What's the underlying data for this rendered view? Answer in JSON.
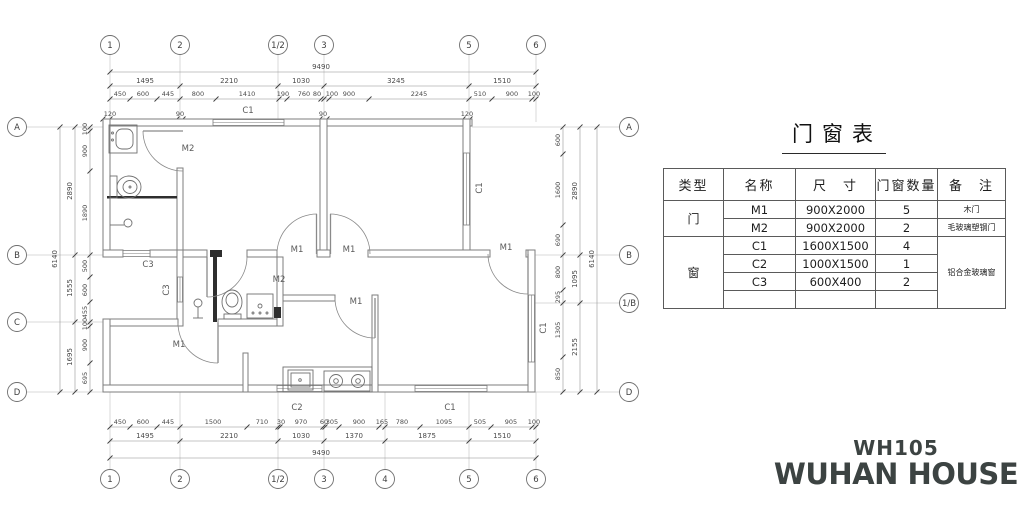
{
  "plan": {
    "bubbles": {
      "top": [
        "1",
        "2",
        "1/2",
        "3",
        "5",
        "6"
      ],
      "bottom": [
        "1",
        "2",
        "1/2",
        "3",
        "4",
        "5",
        "6"
      ],
      "left": [
        "A",
        "B",
        "C",
        "D"
      ],
      "right": [
        "A",
        "B",
        "1/B",
        "D"
      ]
    },
    "dims": {
      "top_total": [
        "9490"
      ],
      "top_row2": [
        "1495",
        "2210",
        "1030",
        "3245",
        "1510"
      ],
      "top_fine": [
        "450",
        "600",
        "445",
        "800",
        "1410",
        "190",
        "760",
        "80",
        "100",
        "900",
        "2245",
        "510",
        "900",
        "100"
      ],
      "wall_callouts": [
        "120",
        "90",
        "90",
        "120"
      ],
      "bottom_fine": [
        "450",
        "600",
        "445",
        "1500",
        "710",
        "30",
        "970",
        "60",
        "305",
        "900",
        "165",
        "780",
        "1095",
        "505",
        "905",
        "100"
      ],
      "bottom_row2": [
        "1495",
        "2210",
        "1030",
        "1370",
        "1875",
        "1510"
      ],
      "bottom_total": [
        "9490"
      ],
      "left_fine": [
        "100",
        "900",
        "1890",
        "500",
        "600",
        "455",
        "100",
        "900",
        "695"
      ],
      "left_row2": [
        "2890",
        "1555",
        "1695"
      ],
      "left_total": [
        "6140"
      ],
      "right_fine": [
        "600",
        "1600",
        "690",
        "800",
        "295",
        "1305",
        "850"
      ],
      "right_row2": [
        "2890",
        "1095",
        "2155"
      ],
      "right_total": [
        "6140"
      ]
    },
    "tags_h": [
      "C1",
      "M2",
      "C3",
      "M2",
      "M1",
      "M1",
      "M1",
      "M1",
      "M1",
      "C2",
      "C1"
    ],
    "tags_v": [
      "C3",
      "C1",
      "C1"
    ]
  },
  "table": {
    "title": "门窗表",
    "headers": [
      "类型",
      "名称",
      "尺　寸",
      "门窗数量",
      "备　注"
    ],
    "type_groups": [
      {
        "label": "门"
      },
      {
        "label": "窗"
      }
    ],
    "rows": [
      {
        "name": "M1",
        "size": "900X2000",
        "qty": "5",
        "remark": "木门"
      },
      {
        "name": "M2",
        "size": "900X2000",
        "qty": "2",
        "remark": "毛玻璃塑钢门"
      },
      {
        "name": "C1",
        "size": "1600X1500",
        "qty": "4"
      },
      {
        "name": "C2",
        "size": "1000X1500",
        "qty": "1"
      },
      {
        "name": "C3",
        "size": "600X400",
        "qty": "2"
      }
    ],
    "window_remark": "铝合金玻璃窗"
  },
  "logo": {
    "model": "WH105",
    "brand": "WUHAN HOUSE"
  }
}
